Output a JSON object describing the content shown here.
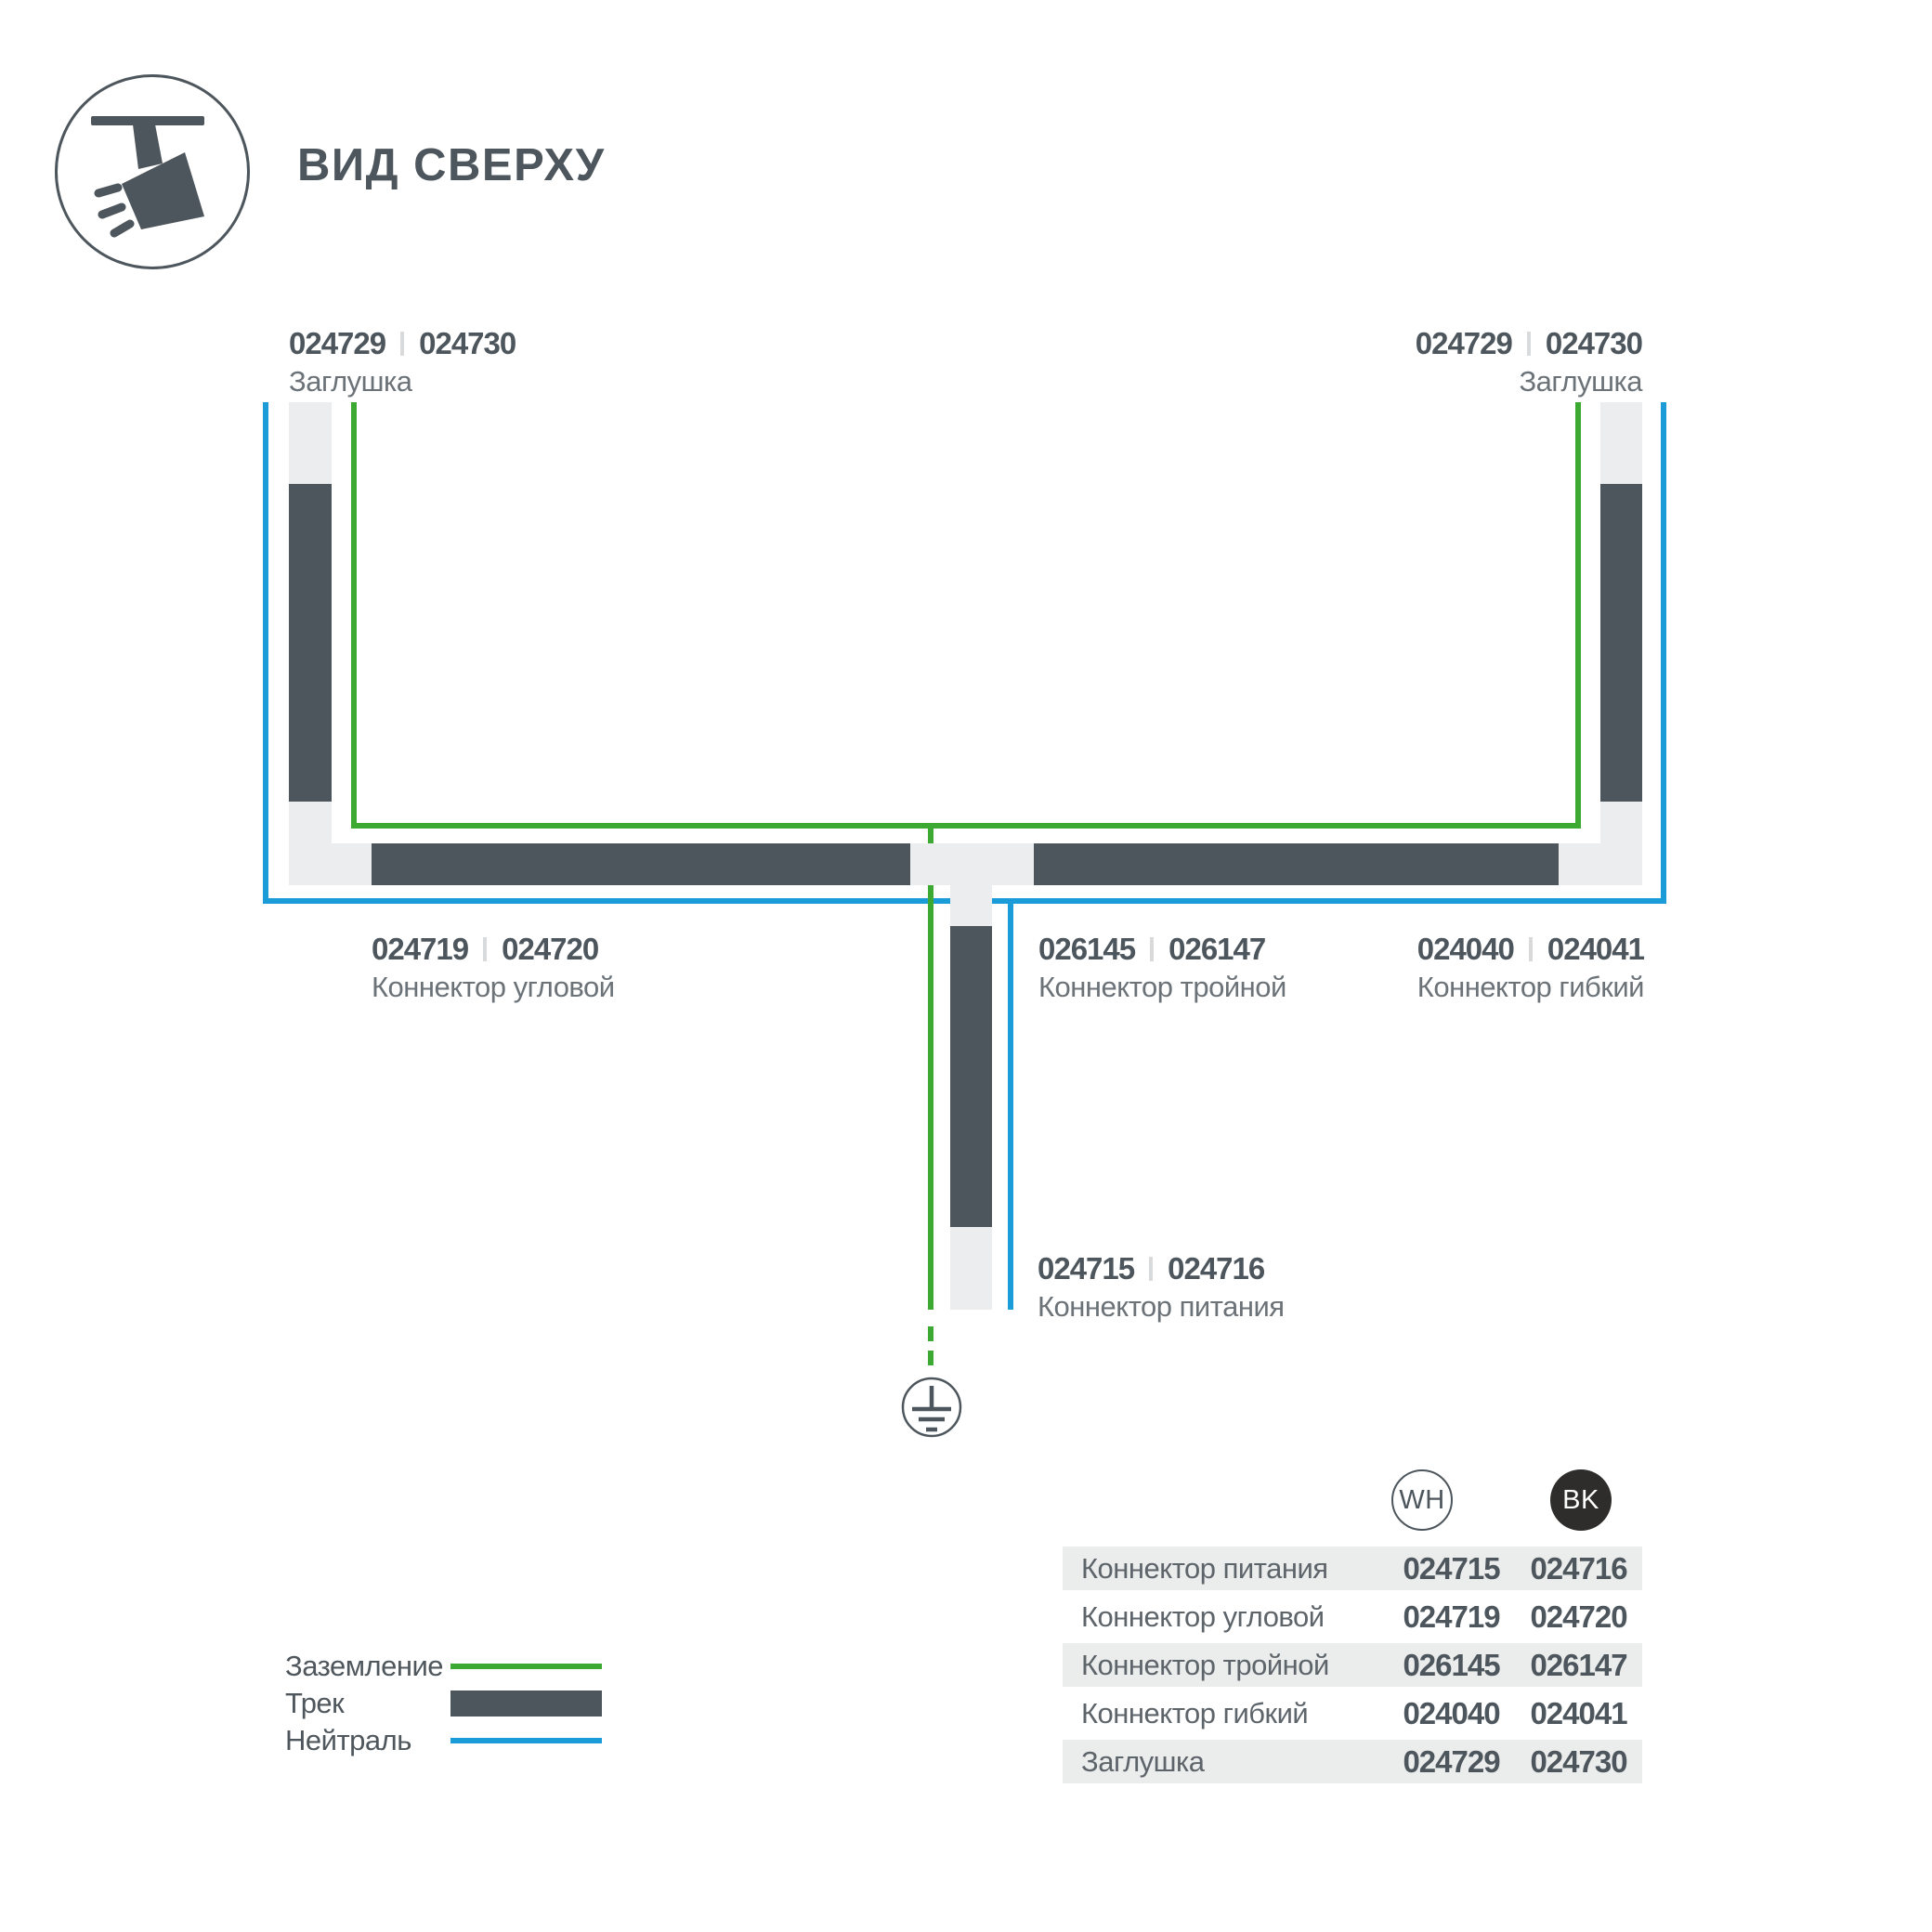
{
  "header": {
    "title": "ВИД СВЕРХУ"
  },
  "colors": {
    "track": "#4d565c",
    "ground": "#3caa32",
    "neutral": "#1b9cd9",
    "light": "#ebedee",
    "rowgray": "#ebecec",
    "textsec": "#6b7278",
    "sep": "#d8dadb",
    "bkbadge": "#2e2d2b"
  },
  "icons": {
    "logo": "track-spotlight-icon",
    "ground_symbol": "earth-ground-icon"
  },
  "diagram": {
    "labels": {
      "cap_left": {
        "num_wh": "024729",
        "num_bk": "024730",
        "name": "Заглушка"
      },
      "cap_right": {
        "num_wh": "024729",
        "num_bk": "024730",
        "name": "Заглушка"
      },
      "corner": {
        "num_wh": "024719",
        "num_bk": "024720",
        "name": "Коннектор угловой"
      },
      "triple": {
        "num_wh": "026145",
        "num_bk": "026147",
        "name": "Коннектор тройной"
      },
      "flexible": {
        "num_wh": "024040",
        "num_bk": "024041",
        "name": "Коннектор гибкий"
      },
      "power": {
        "num_wh": "024715",
        "num_bk": "024716",
        "name": "Коннектор питания"
      }
    }
  },
  "legend": {
    "items": [
      {
        "label": "Заземление",
        "type": "ground"
      },
      {
        "label": "Трек",
        "type": "track"
      },
      {
        "label": "Нейтраль",
        "type": "neutral"
      }
    ]
  },
  "table": {
    "col_wh": "WH",
    "col_bk": "BK",
    "rows": [
      {
        "name": "Коннектор питания",
        "wh": "024715",
        "bk": "024716"
      },
      {
        "name": "Коннектор угловой",
        "wh": "024719",
        "bk": "024720"
      },
      {
        "name": "Коннектор тройной",
        "wh": "026145",
        "bk": "026147"
      },
      {
        "name": "Коннектор гибкий",
        "wh": "024040",
        "bk": "024041"
      },
      {
        "name": "Заглушка",
        "wh": "024729",
        "bk": "024730"
      }
    ]
  }
}
